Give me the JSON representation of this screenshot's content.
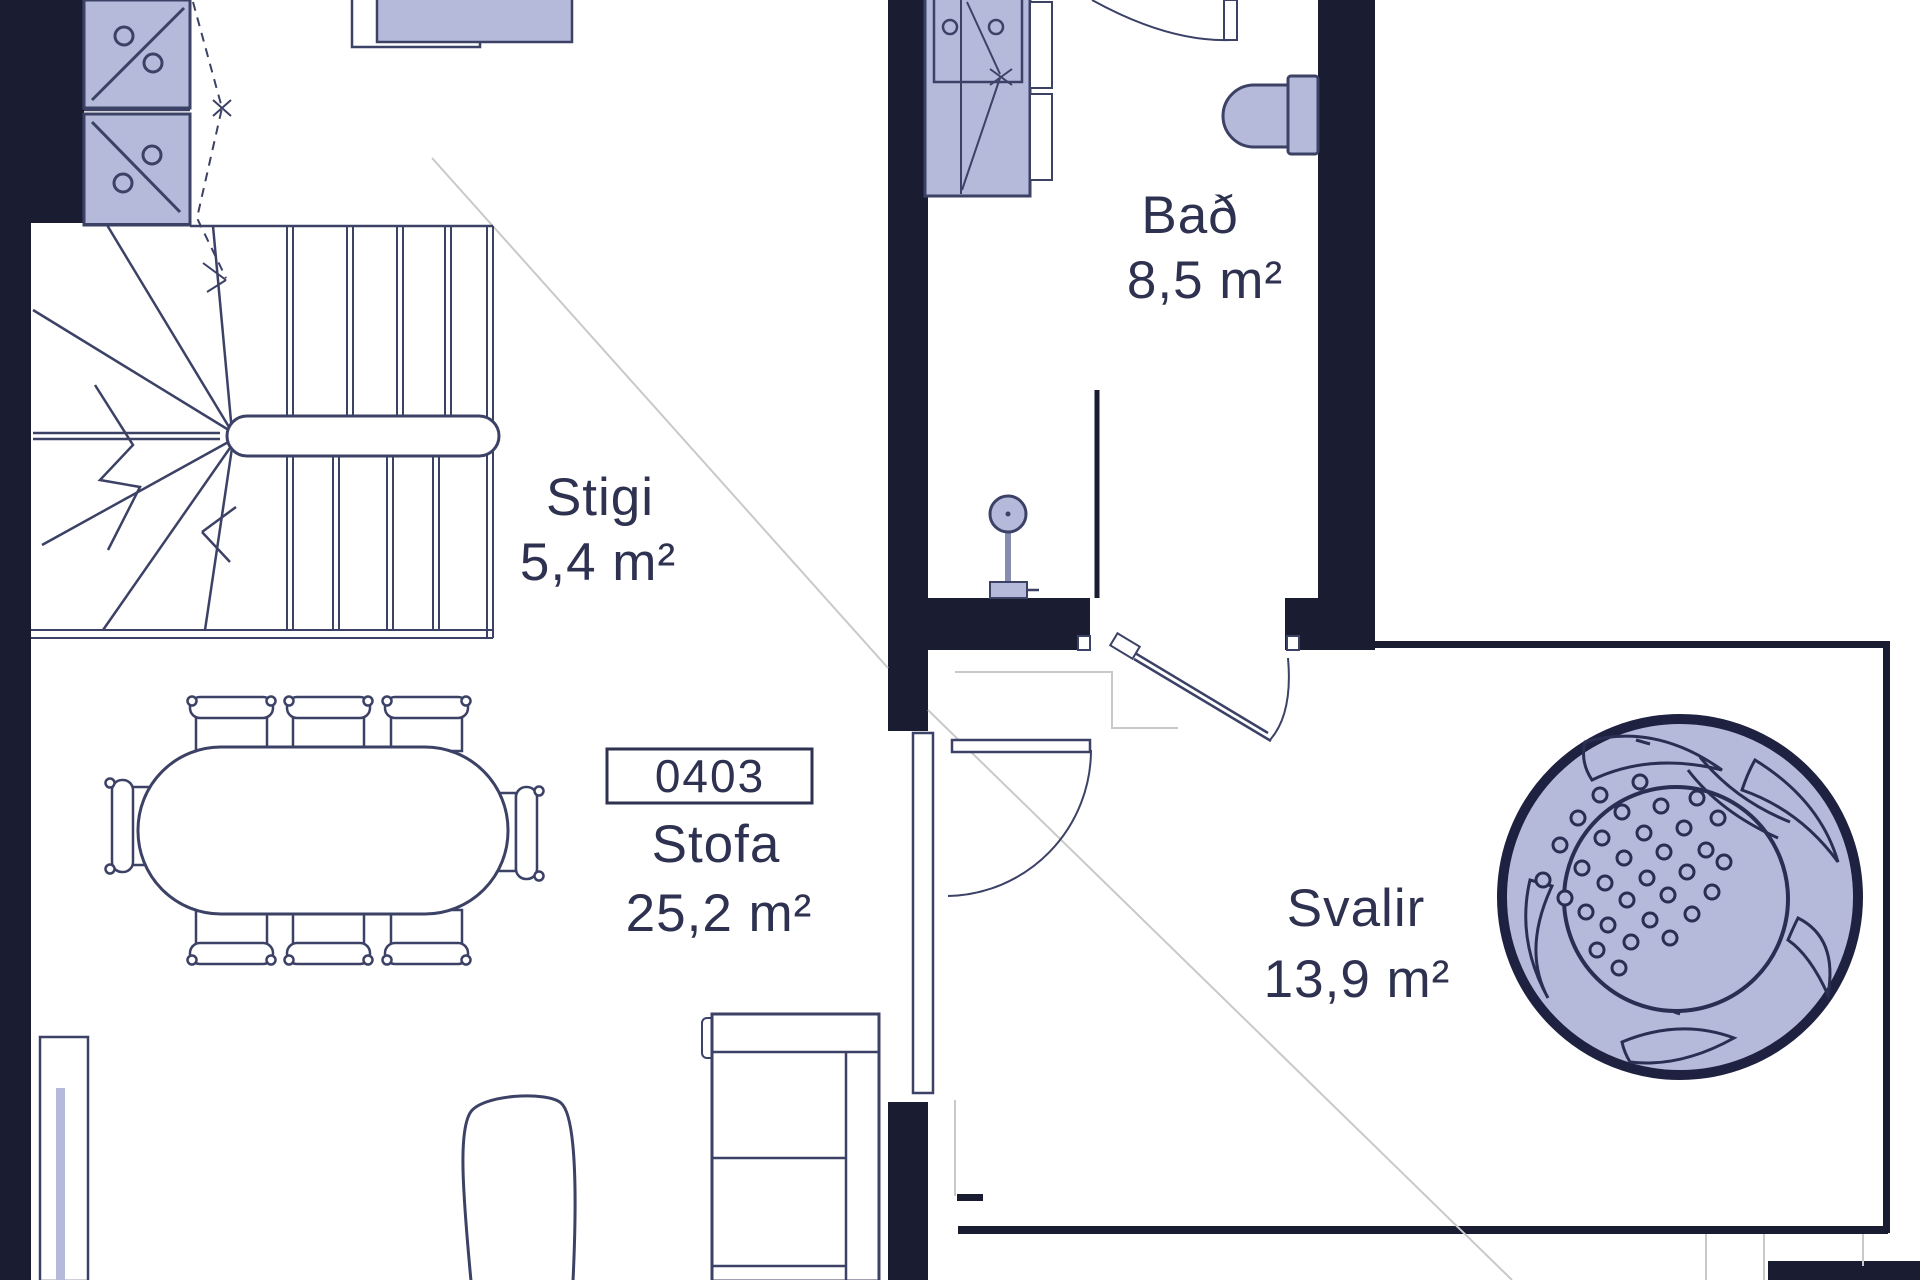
{
  "plan": {
    "rooms": {
      "stigi": {
        "name": "Stigi",
        "area": "5,4 m²"
      },
      "bad": {
        "name": "Bað",
        "area": "8,5 m²"
      },
      "stofa": {
        "name": "Stofa",
        "area": "25,2 m²",
        "unit": "0403"
      },
      "svalir": {
        "name": "Svalir",
        "area": "13,9 m²"
      }
    },
    "colors": {
      "wall": "#1a1c31",
      "line": "#3c4166",
      "furniture_fill": "#b5badb",
      "faint_line": "#c9c9c9",
      "label_text": "#2e3250"
    }
  }
}
